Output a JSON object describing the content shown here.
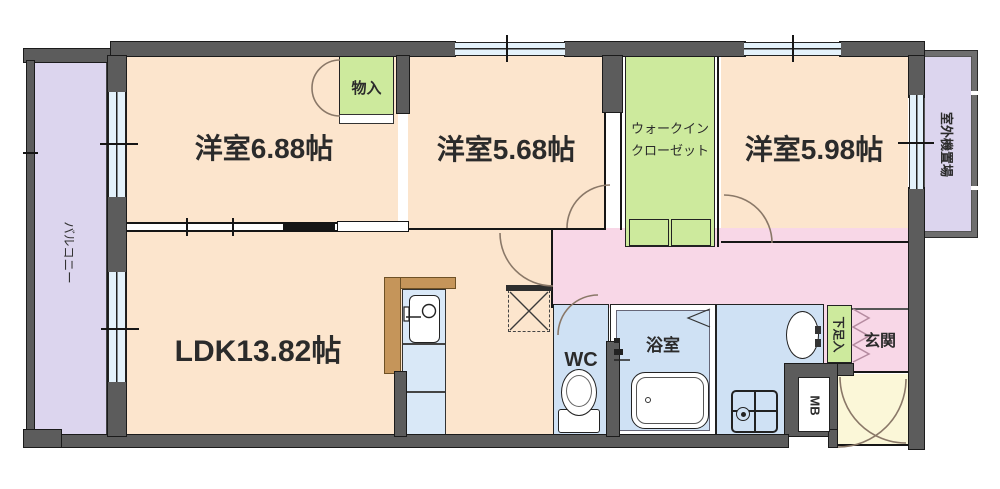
{
  "rooms": {
    "bedroom1": {
      "label": "洋室6.88帖"
    },
    "bedroom2": {
      "label": "洋室5.68帖"
    },
    "bedroom3": {
      "label": "洋室5.98帖"
    },
    "ldk": {
      "label": "LDK13.82帖"
    },
    "walk_in_closet": {
      "label_line1": "ウォークイン",
      "label_line2": "クローゼット"
    },
    "storage": {
      "label": "物入"
    },
    "toilet": {
      "label": "WC"
    },
    "bathroom": {
      "label": "浴室"
    },
    "entrance": {
      "label": "玄関"
    },
    "shoe_cabinet": {
      "label": "下足入"
    },
    "meter_box": {
      "label": "MB"
    },
    "balcony": {
      "label": "バルコニー"
    },
    "outdoor_unit_space": {
      "label": "室外機置場"
    }
  },
  "colors": {
    "wall_gray": "#5c5c5c",
    "room_peach": "#fce5cd",
    "hallway_pink": "#f8d7e7",
    "closet_green": "#cdea9d",
    "sanitary_blue": "#cfe1f4",
    "balcony_lavender": "#dcd5ee",
    "window_blue": "#e4f2fb",
    "entry_porch_yellow": "#fbf7d8",
    "kitchen_counter_brown": "#c5955a"
  }
}
